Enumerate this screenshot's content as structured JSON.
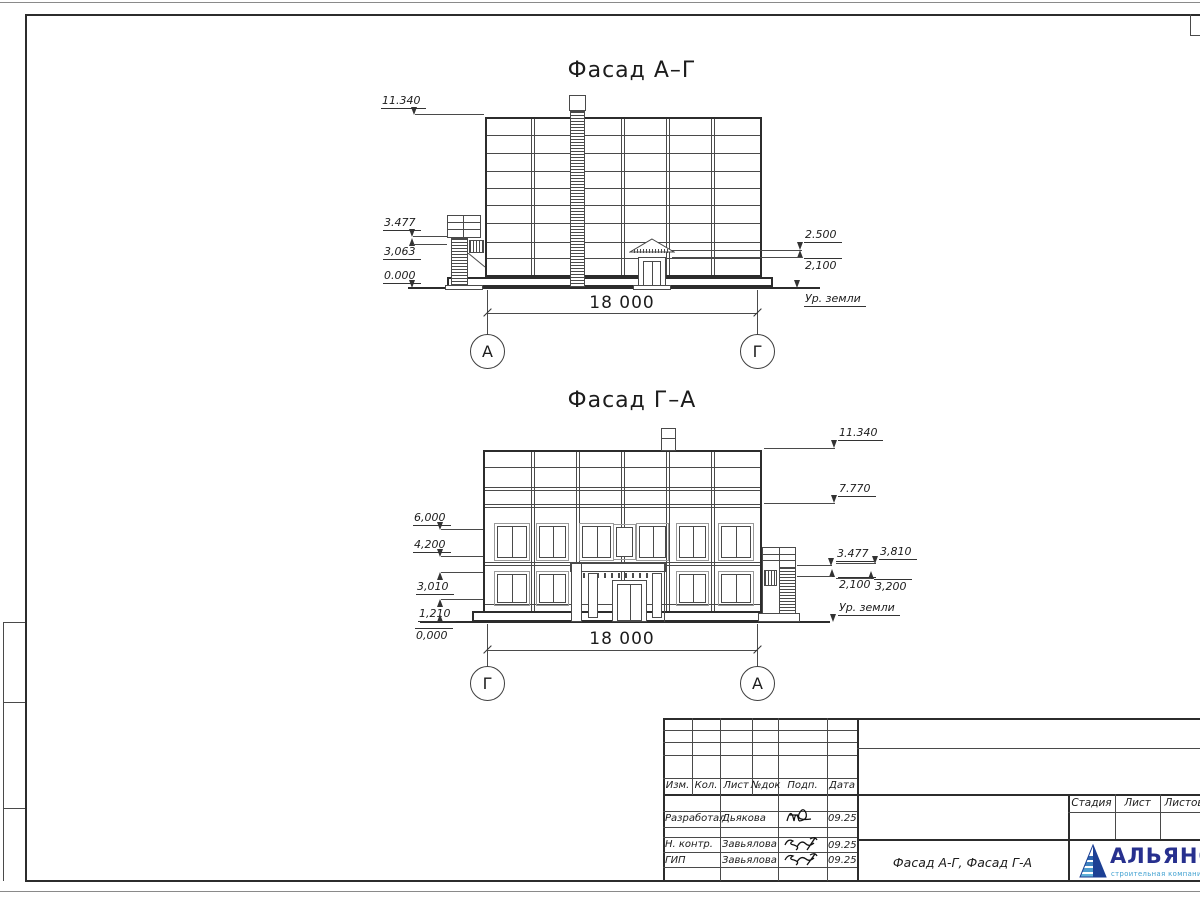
{
  "sheet": {
    "facade_ag": {
      "title": "Фасад А–Г",
      "marks_left": [
        "11.340",
        "3.477",
        "3,063",
        "0.000"
      ],
      "marks_right": [
        "2.500",
        "2,100"
      ],
      "ground": "Ур. земли",
      "dim": "18 000",
      "axis_left": "А",
      "axis_right": "Г"
    },
    "facade_ga": {
      "title": "Фасад Г–А",
      "marks_left": [
        "6,000",
        "4,200",
        "3,010",
        "1,210",
        "0,000"
      ],
      "marks_right": [
        "11.340",
        "7.770",
        "3.477",
        "2,100"
      ],
      "marks_right_outer": [
        "3,810",
        "3,200"
      ],
      "ground": "Ур. земли",
      "dim": "18 000",
      "axis_left": "Г",
      "axis_right": "А"
    },
    "title_block": {
      "change_cols": [
        "Изм.",
        "Кол.",
        "Лист",
        "№док",
        "Подп.",
        "Дата"
      ],
      "sign_rows": [
        {
          "role": "Разработал",
          "name": "Дьякова",
          "date": "09.25"
        },
        {
          "role": "Н. контр.",
          "name": "Завьялова",
          "date": "09.25"
        },
        {
          "role": "ГИП",
          "name": "Завьялова",
          "date": "09.25"
        }
      ],
      "drawing_title": "Фасад А-Г, Фасад Г-А",
      "stage_cols": [
        "Стадия",
        "Лист",
        "Листов"
      ],
      "logo": {
        "name": "АЛЬЯНС",
        "subtitle": "строительная компания"
      }
    }
  }
}
